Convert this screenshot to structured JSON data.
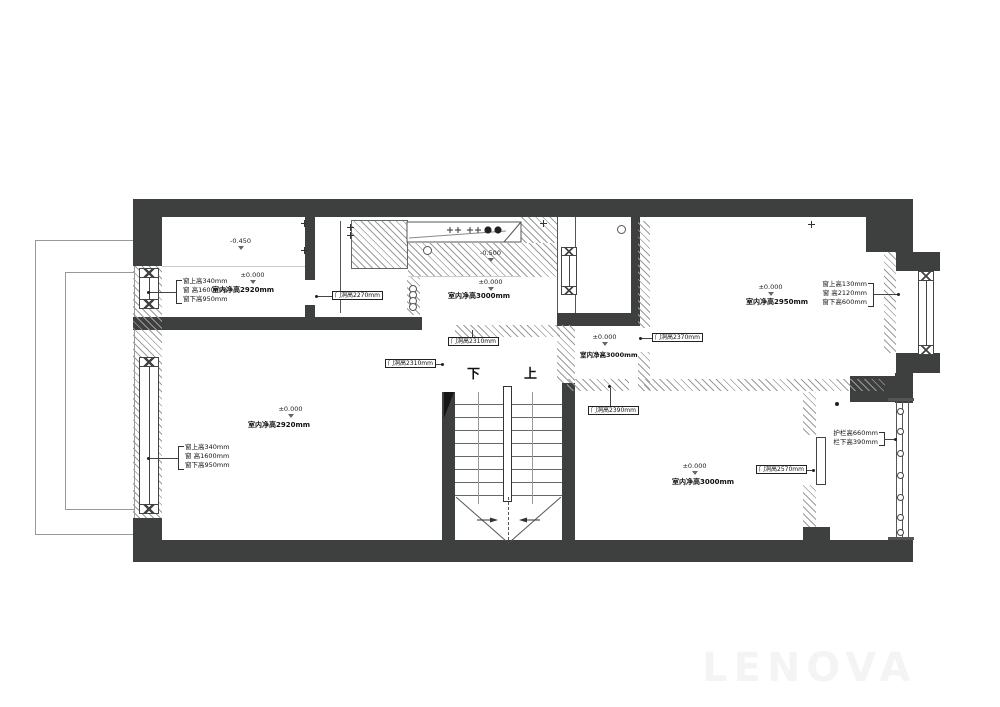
{
  "rooms": {
    "top_left": {
      "upper_level": "-0.450",
      "level": "±0.000",
      "clear_height": "室内净高2920mm",
      "window": [
        "窗上高340mm",
        "窗 高1600mm",
        "窗下高950mm"
      ],
      "door_height": "门洞高2270mm"
    },
    "kitchen": {
      "upper_level": "-0.500",
      "level": "±0.000",
      "clear_height": "室内净高3000mm",
      "door_height": "门洞高2310mm"
    },
    "living": {
      "level": "±0.000",
      "clear_height": "室内净高2920mm",
      "window": [
        "窗上高340mm",
        "窗 高1600mm",
        "窗下高950mm"
      ],
      "door_height": "门洞高2310mm"
    },
    "corridor": {
      "level": "±0.000",
      "clear_height": "室内净高3000mm"
    },
    "top_right": {
      "level": "±0.000",
      "clear_height": "室内净高2950mm",
      "window": [
        "窗上高130mm",
        "窗 高2120mm",
        "窗下高600mm"
      ],
      "door_height": "门洞高2370mm"
    },
    "bottom_right": {
      "level": "±0.000",
      "clear_height": "室内净高3000mm",
      "door_height_top": "门洞高2390mm",
      "door_height_right": "门洞高2570mm"
    },
    "balcony": {
      "rail": [
        "护栏高660mm",
        "栏下高390mm"
      ]
    }
  },
  "stairs": {
    "down": "下",
    "up": "上"
  },
  "watermark": "LENOVA",
  "colors": {
    "wall": "#3e3f3f",
    "hatch": "#9b9b9b",
    "line": "#444444"
  }
}
